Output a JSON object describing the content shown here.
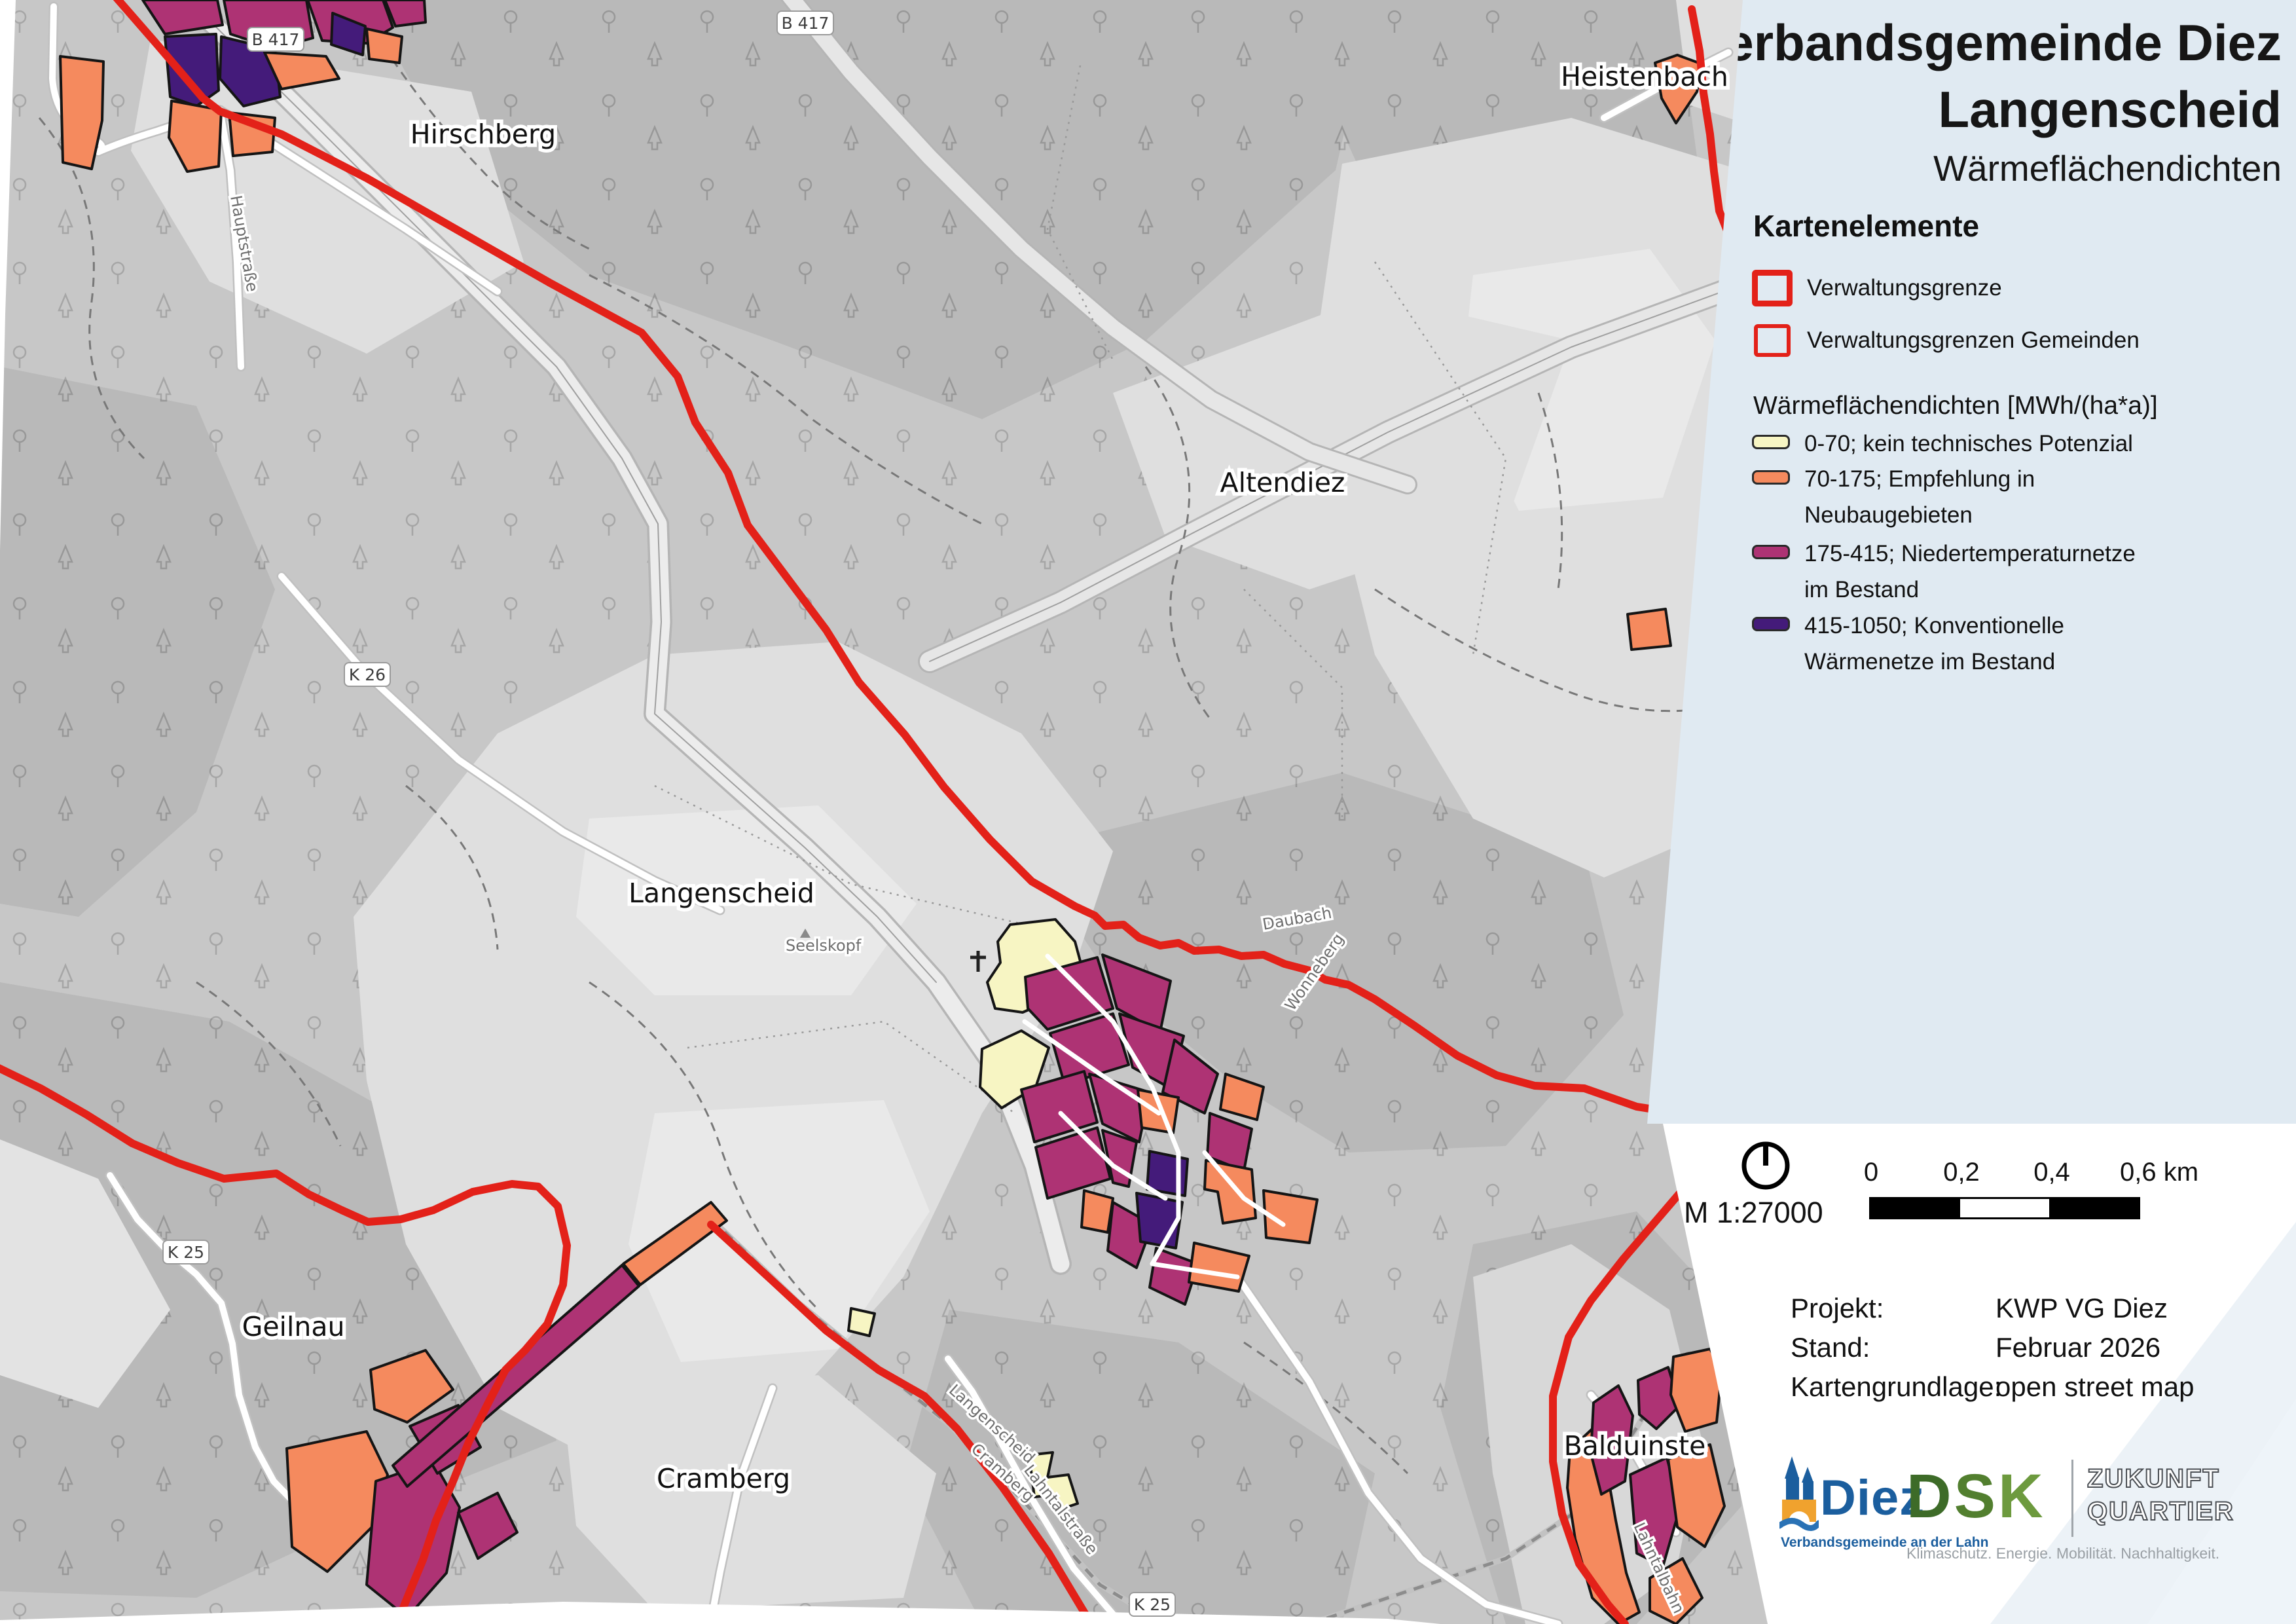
{
  "title": {
    "line1": "Verbandsgemeinde Diez",
    "line2": "Langenscheid",
    "subtitle": "Wärmeflächendichten"
  },
  "legend": {
    "heading": "Kartenelemente",
    "boundary_items": [
      {
        "label": "Verwaltungsgrenze"
      },
      {
        "label": "Verwaltungsgrenzen Gemeinden"
      }
    ],
    "heat_heading": "Wärmeflächendichten [MWh/(ha*a)]",
    "heat_items": [
      {
        "color": "#f7f5c3",
        "line1": "0-70; kein technisches Potenzial",
        "line2": ""
      },
      {
        "color": "#f58a5e",
        "line1": "70-175; Empfehlung in",
        "line2": "Neubaugebieten"
      },
      {
        "color": "#ae3374",
        "line1": "175-415; Niedertemperaturnetze",
        "line2": "im Bestand"
      },
      {
        "color": "#441b7a",
        "line1": "415-1050; Konventionelle",
        "line2": "Wärmenetze im Bestand"
      }
    ]
  },
  "scale": {
    "ratio": "M 1:27000",
    "ticks": [
      "0",
      "0,2",
      "0,4",
      "0,6 km"
    ]
  },
  "project": {
    "rows": [
      {
        "label": "Projekt:",
        "value": "KWP VG Diez"
      },
      {
        "label": "Stand:",
        "value": "Februar 2026"
      },
      {
        "label": "Kartengrundlage:",
        "value": "open street map"
      }
    ]
  },
  "logos": {
    "diez": {
      "name": "Diez",
      "tagline": "Verbandsgemeinde an der Lahn"
    },
    "dsk": {
      "d": "D",
      "s": "S",
      "k": "K",
      "right1": "ZUKUNFT",
      "right2": "QUARTIER",
      "tagline": "Klimaschutz. Energie. Mobilität. Nachhaltigkeit."
    }
  },
  "map": {
    "towns": [
      {
        "name": "Hirschberg"
      },
      {
        "name": "Heistenbach"
      },
      {
        "name": "Altendiez"
      },
      {
        "name": "Langenscheid"
      },
      {
        "name": "Geilnau"
      },
      {
        "name": "Cramberg"
      },
      {
        "name": "Balduinste"
      }
    ],
    "badges": [
      {
        "text": "B 417"
      },
      {
        "text": "B 417"
      },
      {
        "text": "K 26"
      },
      {
        "text": "K 25"
      },
      {
        "text": "K 25"
      }
    ],
    "micro_labels": [
      {
        "text": "Daubach"
      },
      {
        "text": "Wonneberg"
      },
      {
        "text": "Hauptstraße"
      },
      {
        "text": "Lahntalbahn"
      },
      {
        "text": "Lahntalstraße"
      },
      {
        "text": "Langenscheid"
      },
      {
        "text": "Cramberg"
      },
      {
        "text": "Seelskopf"
      }
    ],
    "colors": {
      "boundary_red": "#e32119",
      "density_0_70": "#f7f5c3",
      "density_70_175": "#f58a5e",
      "density_175_415": "#ae3374",
      "density_415_1050": "#441b7a",
      "panel_blue": "#e0eaf2",
      "forest_grey": "#c7c7c7",
      "field_grey": "#dfdfdf"
    }
  }
}
